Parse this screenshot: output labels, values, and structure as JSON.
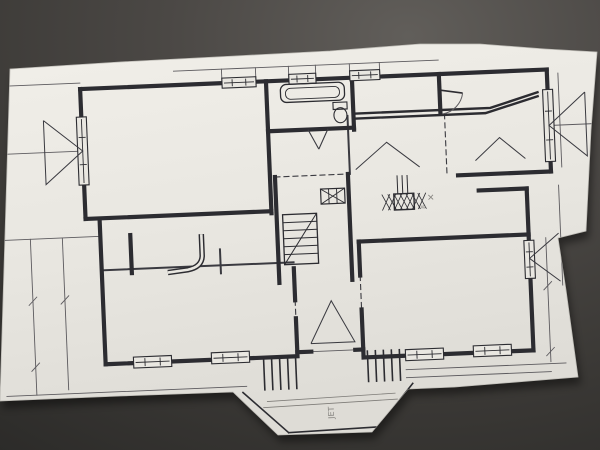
{
  "scene": {
    "surface_gradient": [
      "#615e5a",
      "#4b4845",
      "#3a3835",
      "#2c2b29"
    ],
    "paper_colors": [
      "#f1efe9",
      "#e9e7e1",
      "#dedcd6"
    ],
    "paper_edge_color": "#bfbdb7",
    "ink": "#2c2c31",
    "partition_ink": "#3a3a40",
    "thin_ink": "#5c5a5e",
    "pencil": "#7e7c78",
    "paper_polygon": "10,69 120,62 235,56 330,51 420,44 480,44 545,49 597,52 591,130 586,231 558,238 566,290 578,377 455,387 408,389 372,432 278,435 233,392 120,396 0,401"
  },
  "plan": {
    "rotation_deg": -2.4,
    "rotation_center": [
      300,
      225
    ],
    "walls": [
      [
        86,
        80,
        553,
        80
      ],
      [
        553,
        80,
        553,
        182
      ],
      [
        460,
        182,
        553,
        182
      ],
      [
        86,
        80,
        86,
        210
      ],
      [
        86,
        210,
        272,
        210
      ],
      [
        272,
        80,
        272,
        212
      ],
      [
        272,
        130,
        358,
        130
      ],
      [
        358,
        80,
        358,
        132
      ],
      [
        445,
        80,
        445,
        118
      ],
      [
        277,
        176,
        277,
        282
      ],
      [
        350,
        176,
        350,
        282
      ],
      [
        358,
        244,
        528,
        244
      ],
      [
        528,
        198,
        528,
        360
      ],
      [
        480,
        198,
        528,
        198
      ],
      [
        358,
        244,
        358,
        278
      ],
      [
        358,
        312,
        358,
        360
      ],
      [
        358,
        360,
        528,
        360
      ],
      [
        292,
        268,
        292,
        300
      ],
      [
        292,
        318,
        292,
        352
      ],
      [
        100,
        212,
        100,
        356
      ],
      [
        100,
        356,
        292,
        356
      ],
      [
        292,
        352,
        306,
        352
      ],
      [
        350,
        352,
        358,
        352
      ],
      [
        130,
        228,
        130,
        266
      ]
    ],
    "wall_polylines": [
      "358,116 495,116 544,102",
      "358,121 490,121 544,106"
    ],
    "partitions": [
      [
        100,
        262,
        292,
        262
      ],
      [
        352,
        118,
        352,
        176
      ],
      [
        219,
        246,
        219,
        270
      ]
    ],
    "thin_lines": [
      [
        10,
        74,
        86,
        74
      ],
      [
        8,
        142,
        86,
        142
      ],
      [
        0,
        228,
        100,
        228
      ],
      [
        30,
        228,
        30,
        384
      ],
      [
        62,
        228,
        62,
        380
      ],
      [
        0,
        384,
        240,
        384
      ],
      [
        553,
        136,
        597,
        136
      ],
      [
        564,
        84,
        564,
        178
      ],
      [
        560,
        196,
        560,
        296
      ],
      [
        545,
        248,
        545,
        372
      ],
      [
        400,
        374,
        560,
        374
      ],
      [
        400,
        382,
        545,
        382
      ],
      [
        180,
        66,
        445,
        66
      ],
      [
        228,
        66,
        228,
        80
      ],
      [
        262,
        66,
        262,
        80
      ],
      [
        295,
        66,
        295,
        80
      ],
      [
        322,
        66,
        322,
        80
      ],
      [
        356,
        66,
        356,
        80
      ],
      [
        386,
        66,
        386,
        80
      ],
      [
        306,
        352,
        350,
        352
      ],
      [
        26,
        294,
        34,
        286
      ],
      [
        58,
        294,
        66,
        286
      ],
      [
        26,
        360,
        34,
        352
      ],
      [
        541,
        300,
        549,
        292
      ],
      [
        541,
        366,
        549,
        358
      ]
    ],
    "dashed_lines": [
      [
        277,
        176,
        350,
        176
      ],
      [
        358,
        278,
        358,
        312
      ],
      [
        449,
        120,
        449,
        180
      ],
      [
        292,
        300,
        292,
        318
      ]
    ],
    "windows": [
      [
        228,
        75,
        34,
        10
      ],
      [
        295,
        74,
        27,
        10
      ],
      [
        356,
        73,
        30,
        10
      ],
      [
        81,
        108,
        10,
        68
      ],
      [
        548,
        100,
        10,
        72
      ],
      [
        523,
        250,
        10,
        38
      ],
      [
        400,
        354,
        38,
        11
      ],
      [
        468,
        353,
        38,
        11
      ],
      [
        128,
        350,
        38,
        11
      ],
      [
        206,
        349,
        38,
        11
      ]
    ],
    "triangles": [
      "48,110 86,142 48,174 48,110",
      "590,104 553,136 590,168 590,104",
      "558,244 528,268 558,292",
      "358,172 390,146 422,172",
      "478,168 503,146 528,168",
      "306,344 350,344 328,302 306,344"
    ],
    "doors": {
      "leafs": [
        [
          445,
          96,
          468,
          100
        ]
      ],
      "arcs": [
        "M468,100 A24,24 0 0 1 447,120"
      ],
      "swings": [
        [
          312,
          130,
          322,
          150
        ],
        [
          332,
          130,
          322,
          150
        ]
      ]
    },
    "stairs": {
      "rect": [
        283,
        214,
        34,
        50
      ],
      "diag": [
        283,
        264,
        317,
        214
      ],
      "tread_step": 8
    },
    "hatch_box": {
      "rect": [
        322,
        190,
        24,
        15
      ]
    },
    "chimney": {
      "rect": [
        395,
        198,
        20,
        16
      ],
      "flues": [
        [
          399,
          180,
          399,
          198
        ],
        [
          404,
          180,
          404,
          198
        ],
        [
          409,
          180,
          409,
          198
        ]
      ]
    },
    "bathtub": {
      "outer": [
        286,
        84,
        64,
        18
      ],
      "inner": [
        291,
        88,
        54,
        11
      ]
    },
    "toilet": {
      "tank": [
        338,
        104,
        14,
        7
      ],
      "bowl": [
        345,
        117,
        6.5,
        7.5
      ]
    },
    "counter_hook_path": "M201,230 L201,252 Q200,263 186,265 L166,267",
    "porch": {
      "outline": [
        [
          236,
          390,
          280,
          432
        ],
        [
          280,
          432,
          370,
          430
        ],
        [
          370,
          430,
          406,
          388
        ]
      ],
      "faint": [
        [
          260,
          400,
          388,
          397
        ],
        [
          256,
          406,
          390,
          403
        ]
      ],
      "steps_left": {
        "xs": [
          258,
          266,
          274,
          282,
          290
        ],
        "y1": 357,
        "y2": 389
      },
      "steps_right": {
        "xs": [
          362,
          370,
          378,
          386,
          394
        ],
        "y1": 353,
        "y2": 385
      }
    },
    "annotations": [
      {
        "text": "JET",
        "x": 326,
        "y": 420,
        "rotate": -90,
        "size": 8
      },
      {
        "text": "✕",
        "x": 428,
        "y": 206,
        "rotate": 0,
        "size": 9
      },
      {
        "text": "8",
        "x": 426,
        "y": 214,
        "rotate": -90,
        "size": 6
      }
    ]
  }
}
